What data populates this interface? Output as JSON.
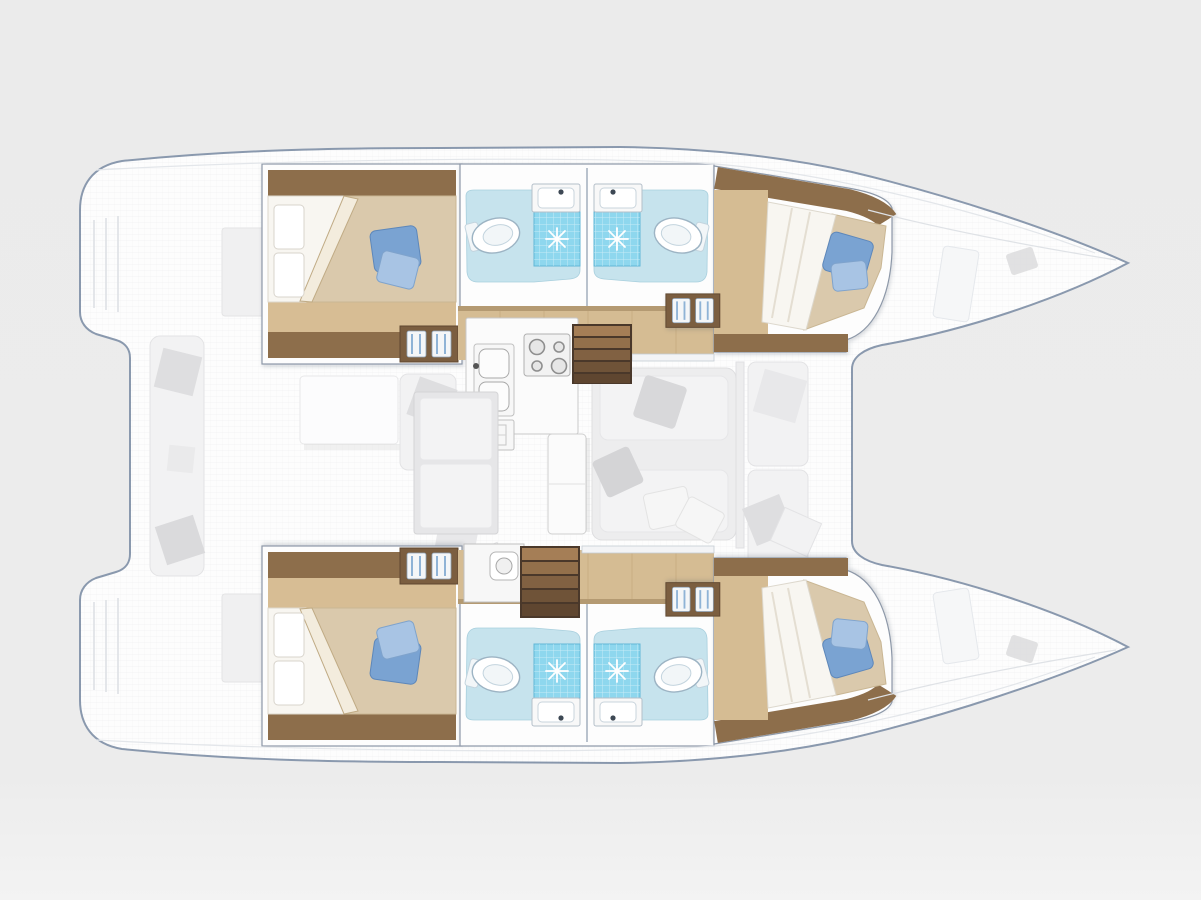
{
  "page": {
    "title": "Catamaran yacht deck plan",
    "subtitle": "Top-down interior layout, bows to the right — 4 double cabins, 4 heads with showers, central saloon with galley"
  },
  "palette": {
    "hull_fill": "#fdfdfd",
    "hull_outline": "#8a99ae",
    "wood_dark": "#8d6e4b",
    "wood_floor": "#d5bc93",
    "wood_light": "#d7bd94",
    "blanket": "#dac9ac",
    "sheet": "#f8f6f1",
    "pillow_blue": "#7aa3d2",
    "pillow_blue_light": "#a8c4e4",
    "bath_floor": "#c6e3ed",
    "shower_tile": "#8ed7ee",
    "stair_wood": "#816142",
    "couch_gray": "#ededee",
    "background": "#ececec"
  },
  "vessel": {
    "type": "sailing catamaran",
    "view": "deck plan from above",
    "cabins": 4,
    "heads": 4,
    "showers": 4,
    "double_berths": 4,
    "hulls": [
      {
        "id": "port",
        "label": "Port hull (top)",
        "rooms": [
          "Aft double cabin",
          "Aft head with shower",
          "Forward head with shower",
          "Forward double cabin"
        ]
      },
      {
        "id": "starboard",
        "label": "Starboard hull (bottom)",
        "rooms": [
          "Aft double cabin",
          "Aft head with shower",
          "Forward head with shower",
          "Forward double cabin"
        ]
      }
    ],
    "saloon_label": "Bridgedeck saloon",
    "saloon_features": [
      "Galley double sink",
      "Cooktop with 4 burners",
      "Oven",
      "Galley appliance cabinet",
      "Dinette table",
      "Dinette bench",
      "Lounge sofa with pillows",
      "Companionway stairs to port hull",
      "Companionway stairs to starboard hull"
    ],
    "aft_cockpit_features": [
      "Bench seat with cushions",
      "Cockpit table",
      "Corner sofa"
    ],
    "fore_cockpit_features": [
      "Twin forward bench seats with pillows"
    ],
    "bow_features": [
      "Deck cleat port bow",
      "Deck cleat starboard bow",
      "Anchor locker hatches"
    ],
    "stern_features": [
      "Port transom steps",
      "Starboard transom steps"
    ]
  },
  "legend": [
    {
      "icon": "bed-icon",
      "meaning": "Double berth with blue accent pillow"
    },
    {
      "icon": "toilet-icon",
      "meaning": "Marine toilet"
    },
    {
      "icon": "shower-star-icon",
      "meaning": "Shower with drain"
    },
    {
      "icon": "sink-icon",
      "meaning": "Wash basin"
    },
    {
      "icon": "stairs-icon",
      "meaning": "Companionway steps"
    }
  ]
}
